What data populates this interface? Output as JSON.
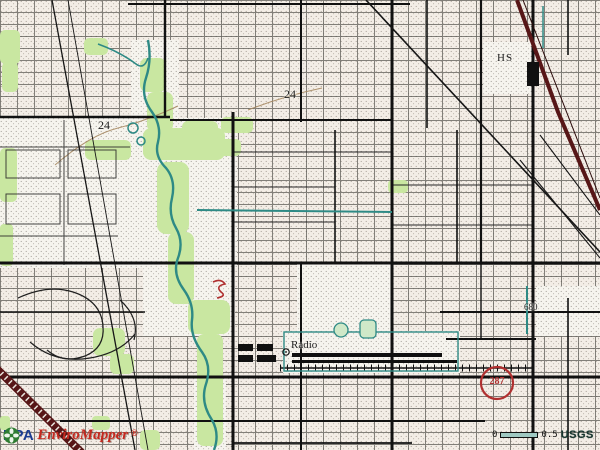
{
  "map_labels": {
    "contour_left": "24",
    "contour_center": "24",
    "school": "HS",
    "radio_facility": "Radio",
    "spot_elevation": "680",
    "route_shield": "287"
  },
  "overlay": {
    "logo": {
      "agency": "EPA",
      "product": "EnviroMapper",
      "registered_mark": "®"
    },
    "scalebar": {
      "start": "0",
      "end": "0.5",
      "source": "USGS"
    }
  },
  "colors": {
    "vegetation_green": "#c9e7a1",
    "water_teal": "#2e8a85",
    "railroad_maroon": "#571617",
    "annotation_red": "#b03030",
    "epa_blue": "#1b3d91",
    "enviromapper_red": "#c5291f",
    "usgs_text": "#17352e"
  },
  "icons": {
    "epa_logo_icon": "epa-flower-icon",
    "radio_tower_symbol": "radio-tower-circle-icon"
  }
}
